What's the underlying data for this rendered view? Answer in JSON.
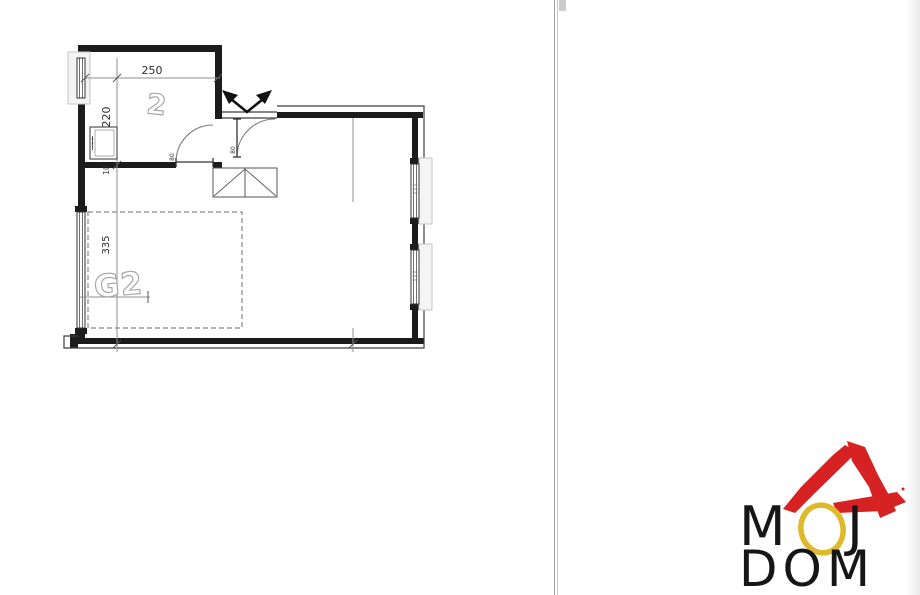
{
  "floor_plan": {
    "room": {
      "label": "2",
      "width": "250",
      "height": "220",
      "wall": "10"
    },
    "g2": {
      "label": "G2",
      "length": "335"
    },
    "doors": {
      "room_door": "80",
      "entry_door": "80"
    }
  },
  "logo": {
    "m": "M",
    "j": "J",
    "dom": "DOM"
  },
  "colors": {
    "wall": "#1c1c1c",
    "outline": "#3f3f3f",
    "dim": "#8f8f8f",
    "dim_text": "#2e2e2e",
    "label_outline": "#a8a8a8",
    "dash": "#8a8a8a",
    "window_box": "#c6c6c6",
    "roof": "#d62222",
    "ring": "#dfb92c",
    "logo_text": "#161616"
  }
}
